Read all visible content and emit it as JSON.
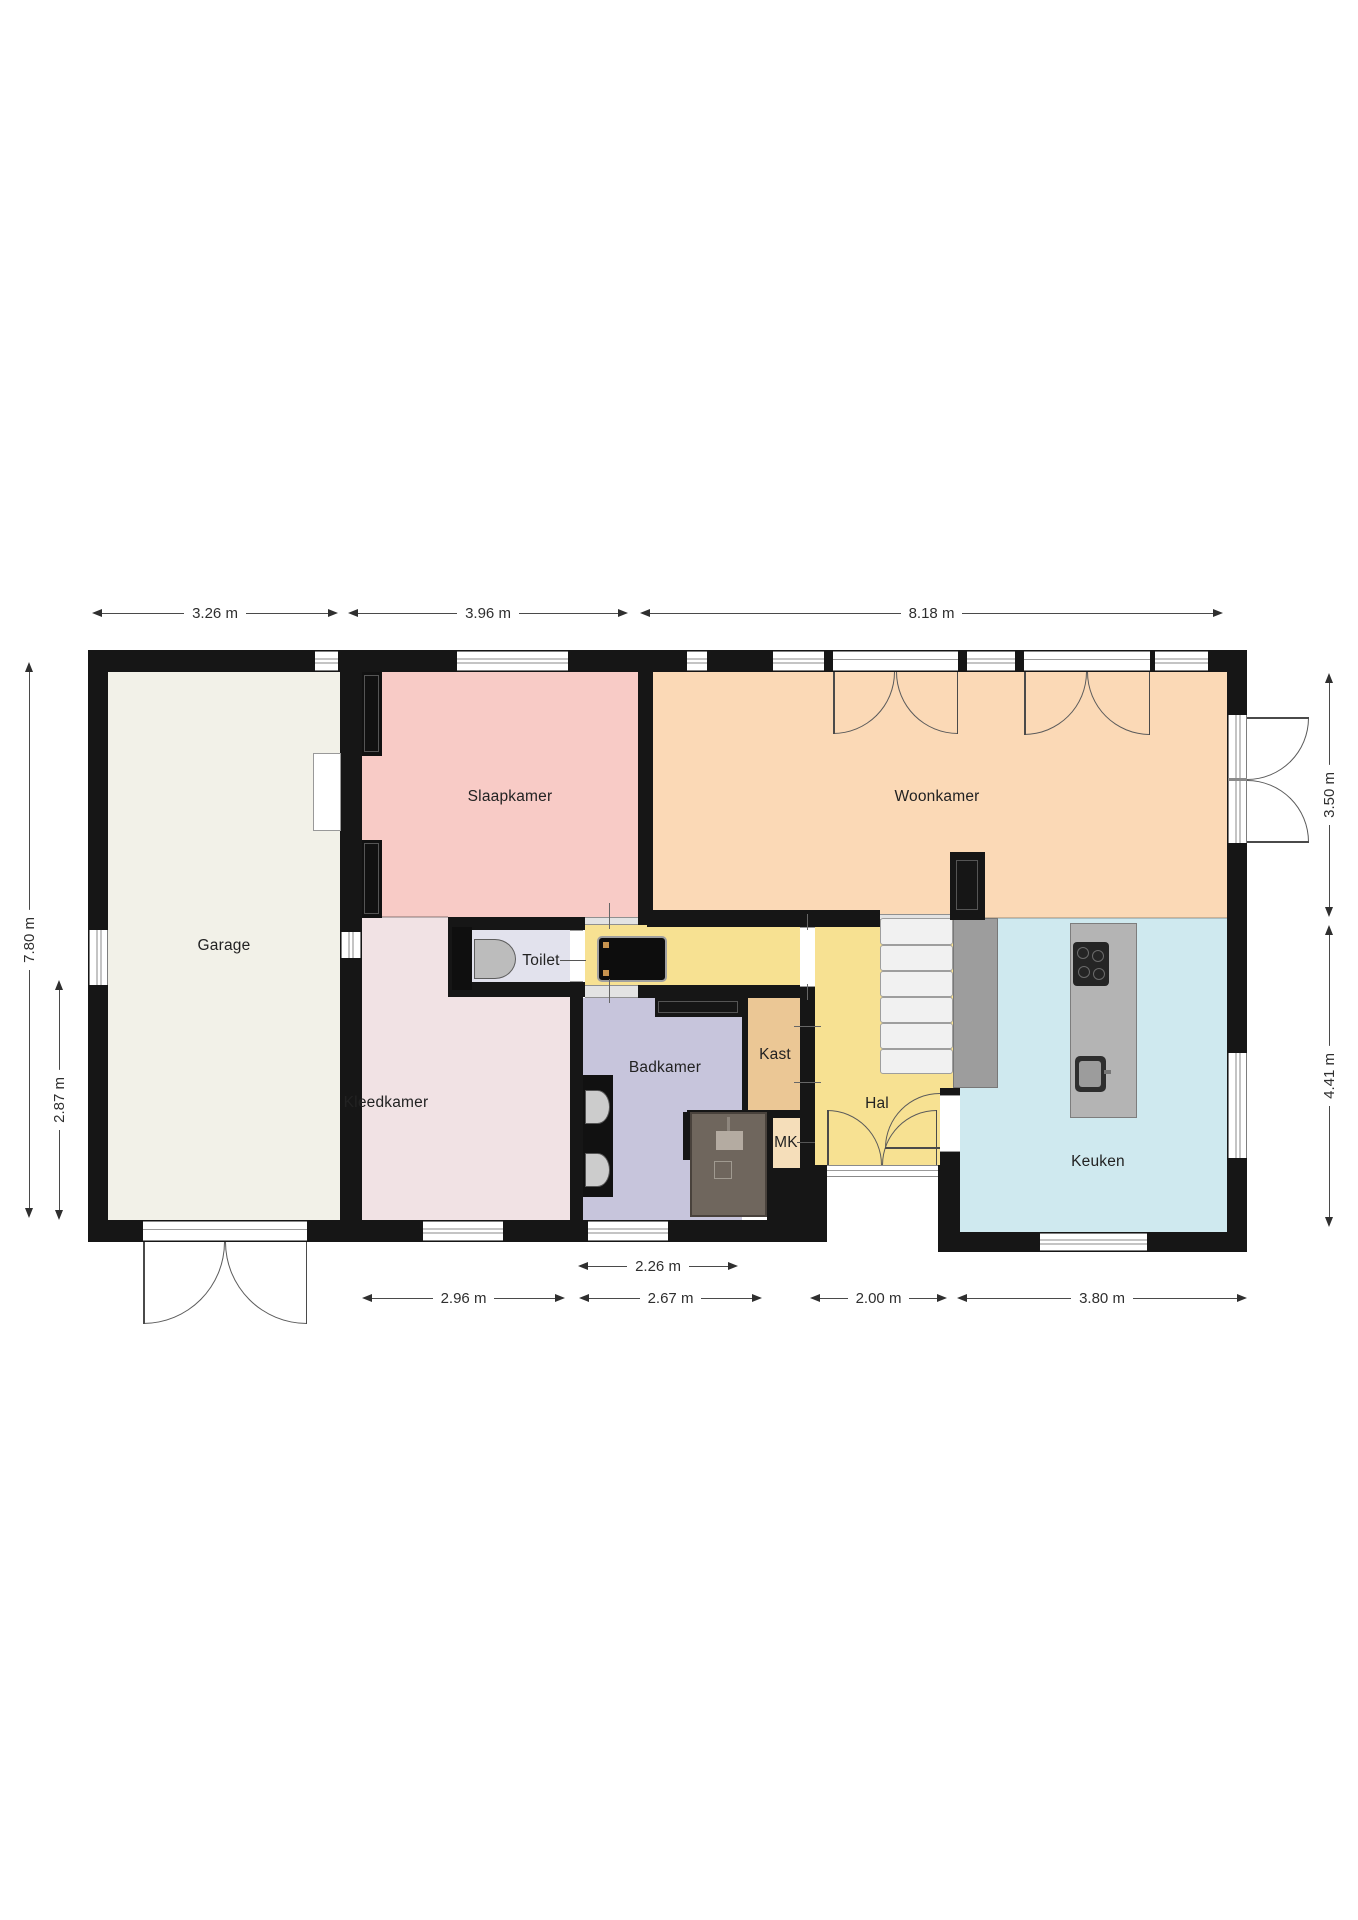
{
  "rooms": {
    "garage": "Garage",
    "slaapkamer": "Slaapkamer",
    "woonkamer": "Woonkamer",
    "kleedkamer": "Kleedkamer",
    "toilet": "Toilet",
    "badkamer": "Badkamer",
    "kast": "Kast",
    "mk": "MK",
    "hal": "Hal",
    "keuken": "Keuken"
  },
  "dimensions": {
    "top": [
      "3.26 m",
      "3.96 m",
      "8.18 m"
    ],
    "left": [
      "7.80 m",
      "2.87 m"
    ],
    "right": [
      "3.50 m",
      "4.41 m"
    ],
    "bottom_upper": [
      "2.26 m"
    ],
    "bottom_lower": [
      "2.96 m",
      "2.67 m",
      "2.00 m",
      "3.80 m"
    ]
  },
  "fixtures": {
    "toilet": "toilet-bowl-icon",
    "badkamer_sinks": "washbasin-icon",
    "shower": "shower-head-icon",
    "cooktop": "cooktop-icon",
    "kitchen_sink": "sink-icon",
    "stairs": "staircase",
    "wardrobes": "wardrobe"
  },
  "colors": {
    "wall": "#161616",
    "garage": "#f2f1e8",
    "slaapkamer": "#f8cbc6",
    "woonkamer": "#fbd9b6",
    "kleedkamer": "#f1e2e4",
    "hal": "#f7e192",
    "keuken": "#cfe9ef",
    "toilet": "#e2e2ed",
    "badkamer": "#c7c5dc",
    "kast": "#ebc795",
    "mk": "#f5deba",
    "shower": "#6f665d",
    "island": "#b4b4b4",
    "stairs": "#f1f1f1"
  }
}
